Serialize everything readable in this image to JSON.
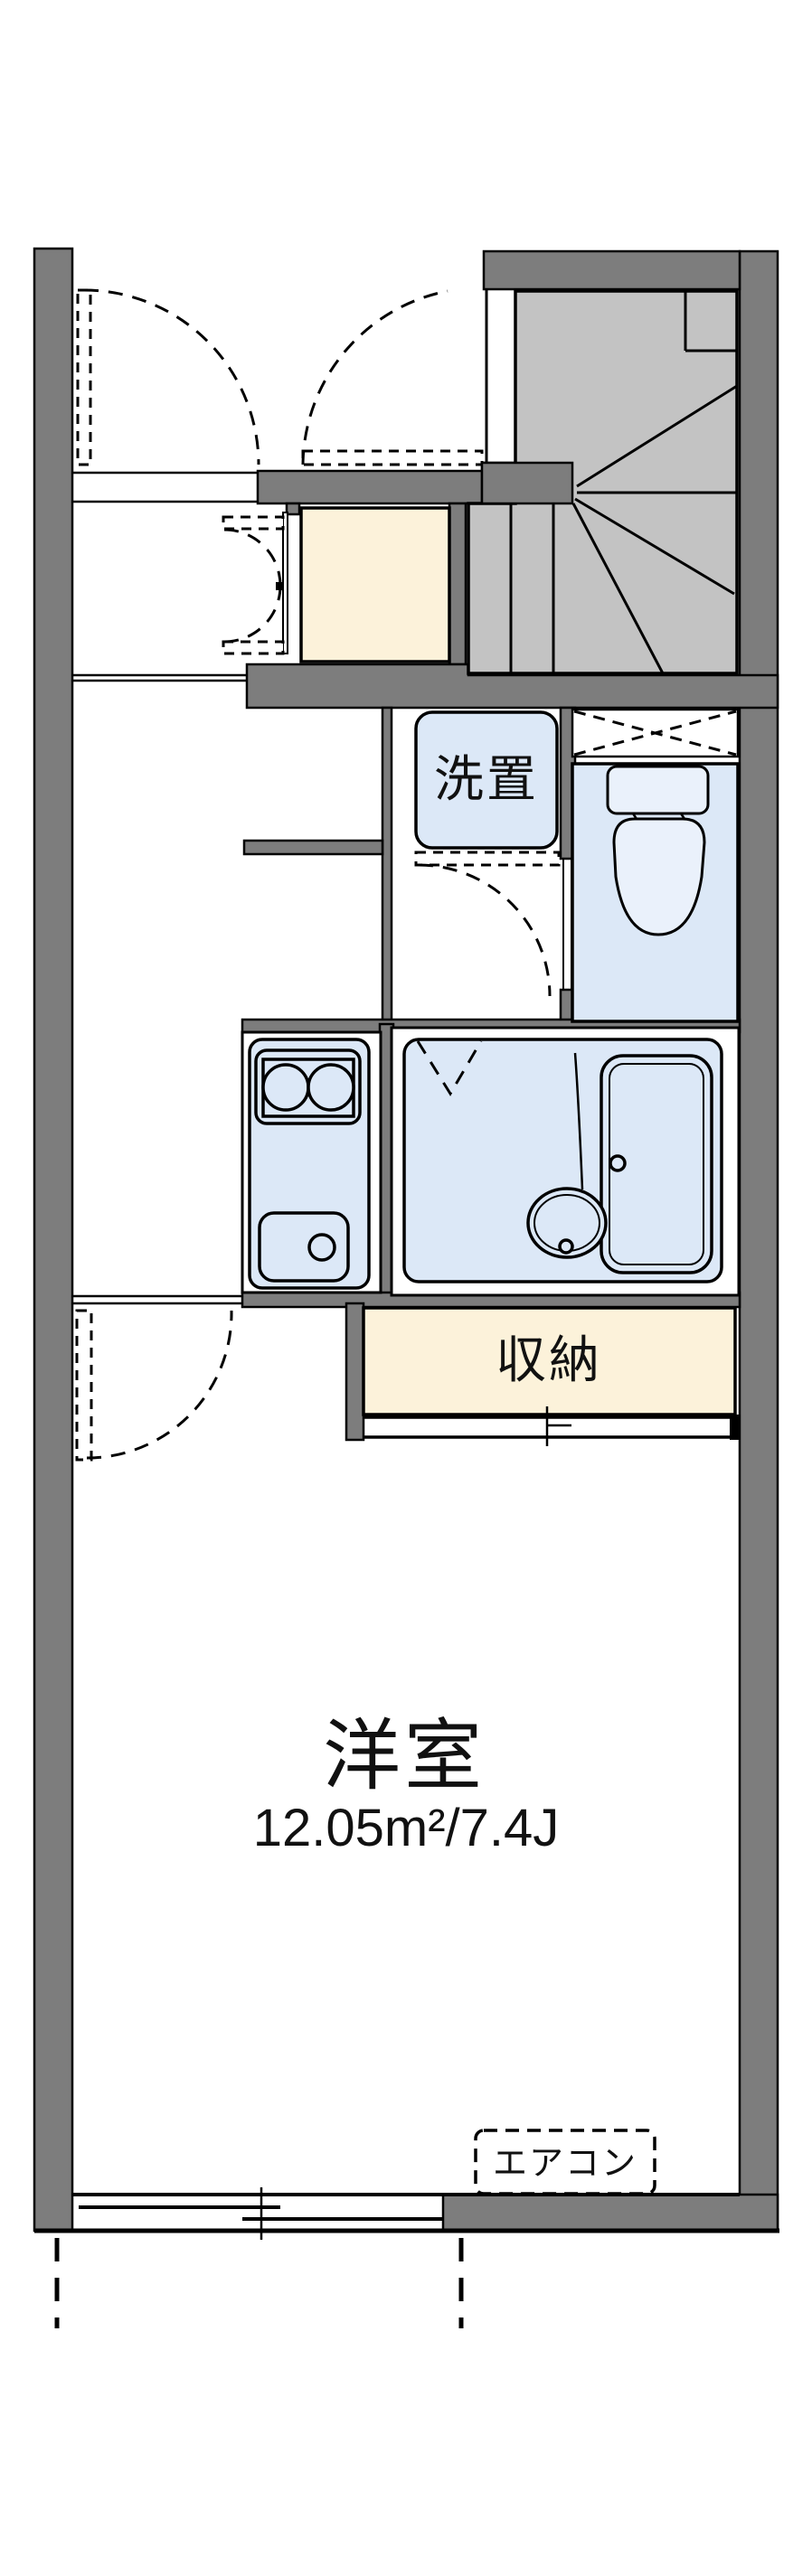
{
  "document": {
    "kind": "Japanese apartment floor plan"
  },
  "labels": {
    "washer_area": "洗置",
    "storage": "収納",
    "western_room": "洋室",
    "western_room_area": "12.05m²/7.4J",
    "air_conditioner": "エアコン"
  },
  "colors": {
    "wall": "#7d7d7d",
    "stair": "#c3c3c3",
    "water": "#dce8f7",
    "fixture": "#eaf1fb",
    "cream": "#fcf2da",
    "ink": "#111111",
    "line": "#000000",
    "bg": "#ffffff"
  }
}
